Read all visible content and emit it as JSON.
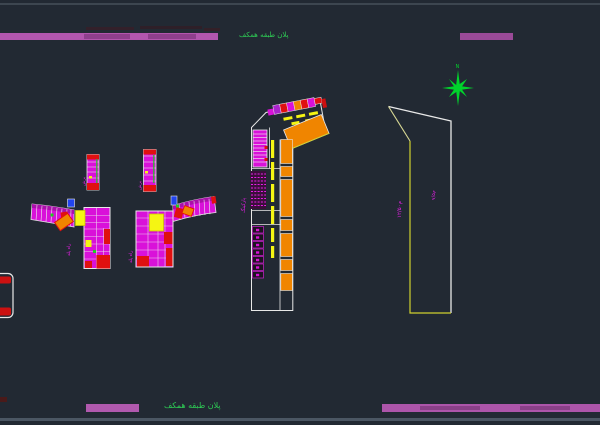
{
  "sheet": {
    "background": "#222933",
    "border_top_color": "#3d4650",
    "border_bottom_color": "#4b5663"
  },
  "titles": {
    "top": "پلان طبقه همکف",
    "bottom": "پلان طبقه همکف"
  },
  "north": {
    "label": "N",
    "color": "#00d42c"
  },
  "labels": {
    "site_width": "۱۲/۵۰م",
    "site_depth": "۷/۵م",
    "parking": "پارکینگ",
    "tower_a": "راه پله",
    "strip_a": "برش",
    "tower_b": "راه پله",
    "strip_b": "برش"
  },
  "palette": {
    "magenta_bar": "#b256ae",
    "cad_magenta": "#d911d9",
    "cad_red": "#e01010",
    "cad_orange": "#f08500",
    "cad_yellow": "#f5f513",
    "cad_green": "#22cc22",
    "cad_white": "#e8e8e8",
    "annotation_magenta": "#e81ee8",
    "title_green": "#2ecc55"
  }
}
